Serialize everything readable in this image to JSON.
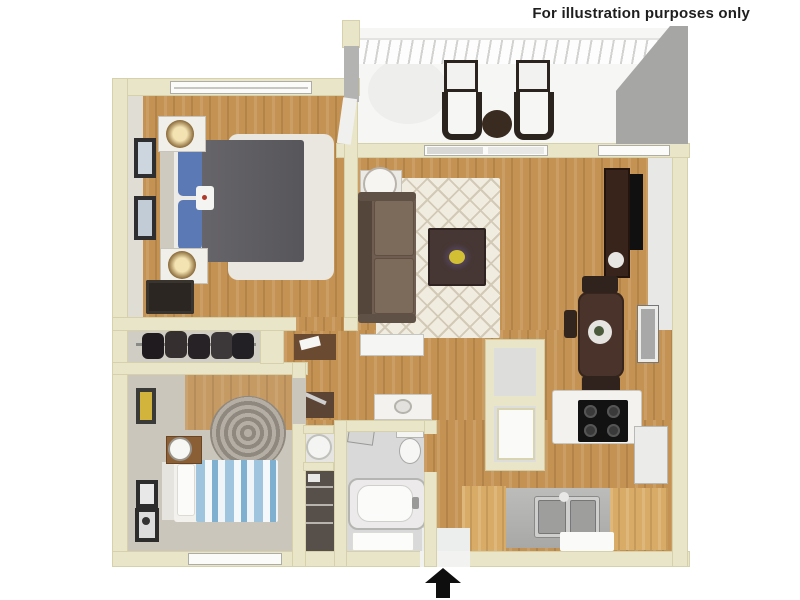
{
  "disclaimer": {
    "text": "For illustration purposes only"
  },
  "floor_plan": {
    "type": "3d-apartment-floor-plan",
    "entrance_arrow_direction": "up",
    "colors": {
      "background": "#ffffff",
      "wall": "#e9e5c8",
      "wood_floor": "#c49354",
      "carpet": "#cbc6bc",
      "bathroom_tile": "#d9d9d9",
      "area_rug": "#f1ece0",
      "sofa_brown": "#6e5d50",
      "comforter_gray": "#5d5c60",
      "pillow_blue": "#5b79b4",
      "bed2_blue_stripe": "#9fc4dd",
      "dark_wood_furniture": "#4a332a",
      "entrance_arrow": "#0e0e0e"
    }
  }
}
